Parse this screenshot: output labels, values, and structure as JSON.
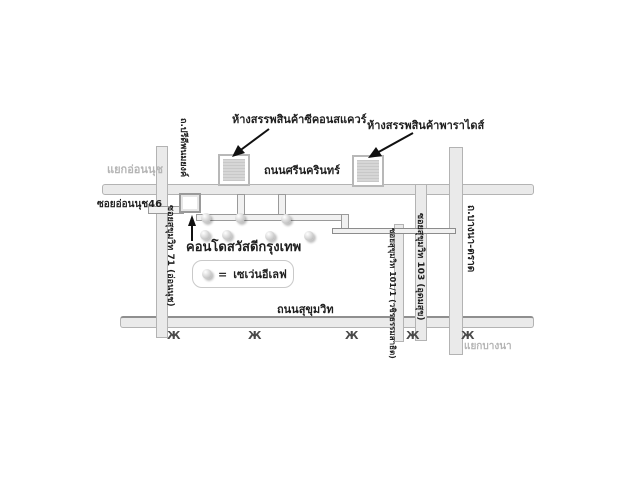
{
  "map": {
    "places": {
      "seacon_square": "ห้างสรรพสินค้าซีคอนสแควร์",
      "paradise": "ห้างสรรพสินค้าพาราไดส์",
      "condo": "คอนโดสวัสดีกรุงเทพ"
    },
    "roads": {
      "srinakarin": "ถนนศรีนครินทร์",
      "sukhumvit": "ถนนสุขุมวิท",
      "onnut46": "ซอยอ่อนนุช46",
      "sukhumvit71": "ซอยสุขุมวิท 71 (อ่อนนุช)",
      "pridi_banomyong": "ถ.ปรีดีพนมยงค์",
      "sukhumvit101_1": "ซอยสุขุมวิท 101/1 (วชิรธรรมสาธิต)",
      "sukhumvit103": "ซอยสุขุมวิท 103 (อุดมสุข)",
      "bangna_trat": "ถ.บางนา-ตราด"
    },
    "junctions": {
      "onnut": "แยกอ่อนนุช",
      "bangna": "แยกบางนา"
    },
    "legend": {
      "equals": "=",
      "label": "เซเว่นอีเลฟ"
    },
    "icons": {
      "seven_eleven_marker": "gray-sphere",
      "station_glyph": "Ж",
      "arrow": "black-pointer"
    },
    "colors": {
      "road_fill": "#eaeaea",
      "road_edge": "#b3b3b3",
      "store_fill": "#cfcfcf",
      "junction_text": "#b5b5b5",
      "text": "#1f1f1f",
      "background": "#ffffff"
    }
  }
}
